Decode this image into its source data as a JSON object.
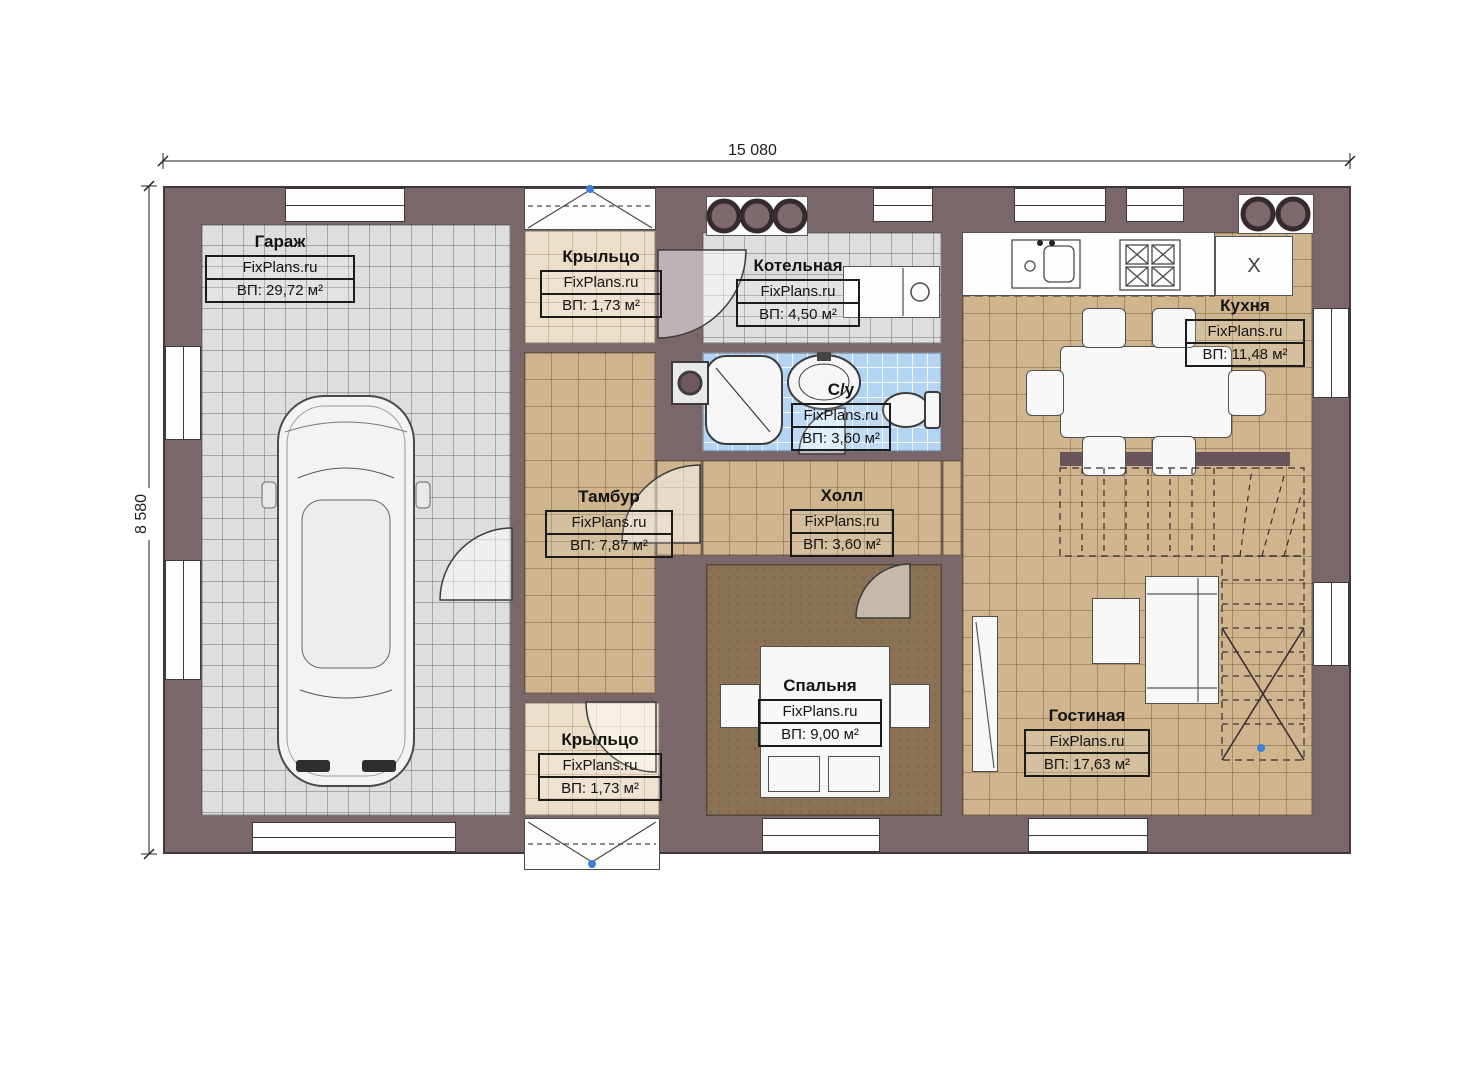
{
  "watermark": "FixPlans.ru",
  "dimensions": {
    "width": "15 080",
    "height": "8 580"
  },
  "rooms": [
    {
      "name": "Гараж",
      "source": "FixPlans.ru",
      "area": "ВП: 29,72 м²"
    },
    {
      "name": "Крыльцо",
      "source": "FixPlans.ru",
      "area": "ВП: 1,73 м²"
    },
    {
      "name": "Котельная",
      "source": "FixPlans.ru",
      "area": "ВП: 4,50 м²"
    },
    {
      "name": "Кухня",
      "source": "FixPlans.ru",
      "area": "ВП: 11,48 м²"
    },
    {
      "name": "С/у",
      "source": "FixPlans.ru",
      "area": "ВП: 3,60 м²"
    },
    {
      "name": "Тамбур",
      "source": "FixPlans.ru",
      "area": "ВП: 7,87 м²"
    },
    {
      "name": "Холл",
      "source": "FixPlans.ru",
      "area": "ВП: 3,60 м²"
    },
    {
      "name": "Спальня",
      "source": "FixPlans.ru",
      "area": "ВП: 9,00 м²"
    },
    {
      "name": "Гостиная",
      "source": "FixPlans.ru",
      "area": "ВП: 17,63 м²"
    },
    {
      "name": "Крыльцо",
      "source": "FixPlans.ru",
      "area": "ВП: 1,73 м²"
    }
  ],
  "appliances": {
    "fridge_label": "X"
  },
  "colors": {
    "wall": "#7b666a",
    "floor_tan": "#cfb48e",
    "floor_gray": "#dedede",
    "floor_blue": "#b3d4f2",
    "floor_cream": "#ecdfc9",
    "carpet_brown": "#8b7254",
    "marker_blue": "#3e7ed8"
  }
}
